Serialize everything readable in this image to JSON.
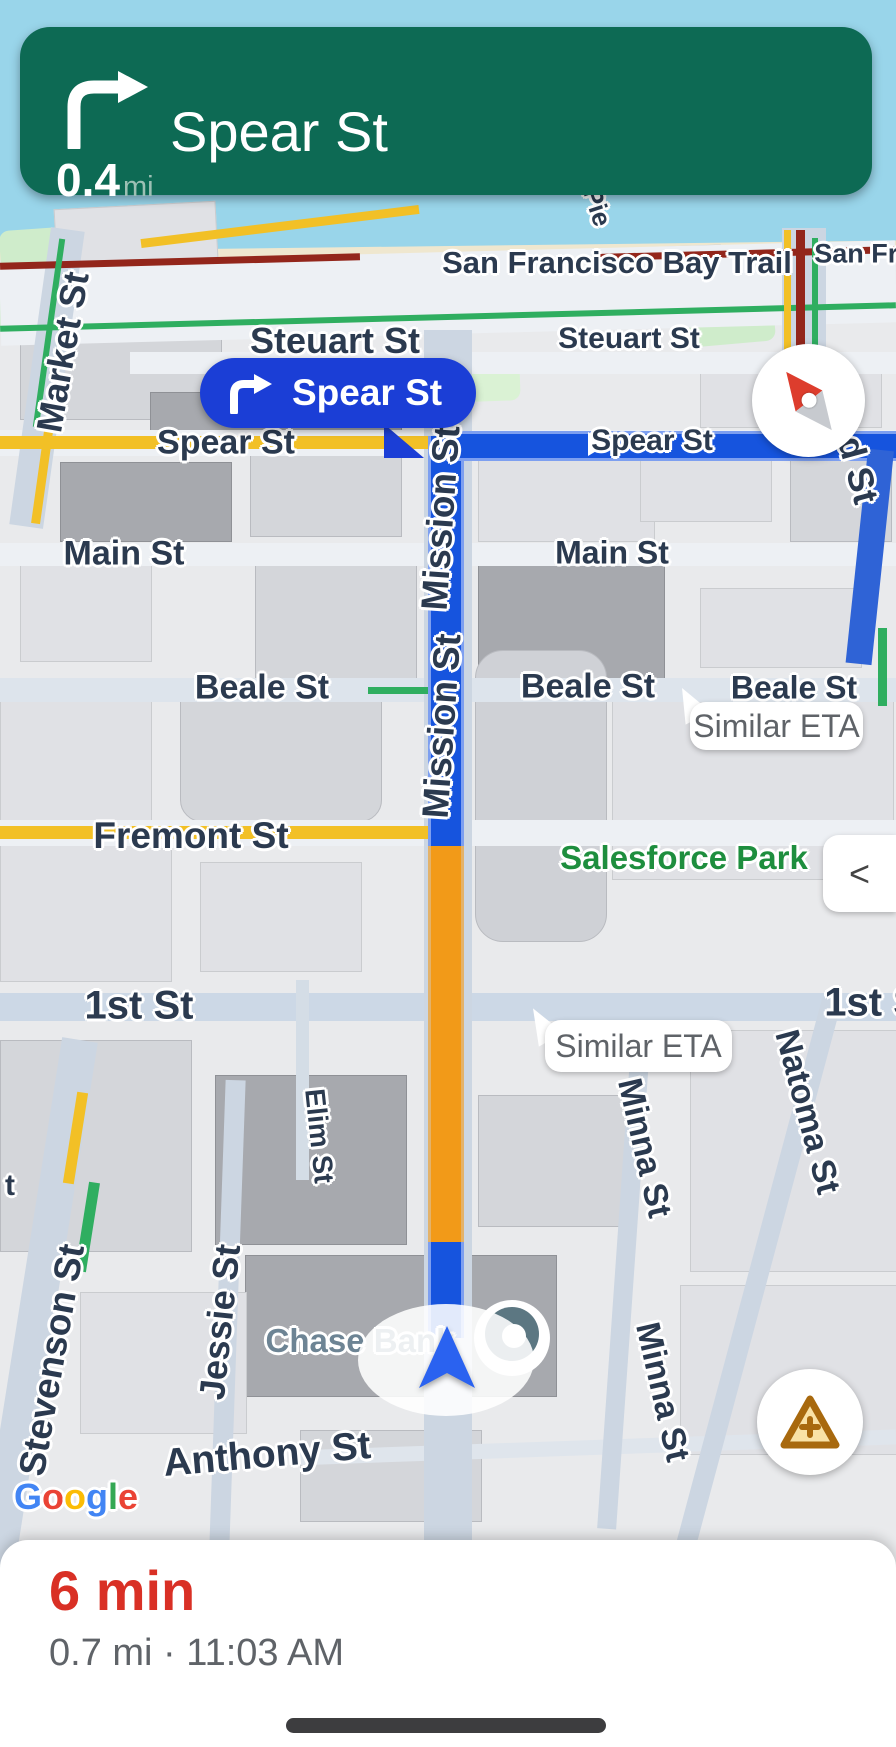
{
  "app": "Google Maps driving navigation",
  "banner": {
    "maneuver": "turn-right",
    "distance_value": "0.4",
    "distance_unit": "mi",
    "instruction": "Spear St"
  },
  "callout": {
    "maneuver": "turn-right",
    "label": "Spear St"
  },
  "bubbles": {
    "beale": "Similar ETA",
    "first": "Similar ETA"
  },
  "controls": {
    "collapse": "<"
  },
  "sheet": {
    "eta": "6 min",
    "details": "0.7 mi · 11:03 AM"
  },
  "streets": {
    "bay_trail": "San Francisco Bay Trail",
    "san_fran_clip": "San Fran",
    "pier": "Pie",
    "market": "Market St",
    "steuart_left": "Steuart St",
    "steuart_right": "Steuart St",
    "spear_left": "Spear St",
    "spear_right": "Spear St",
    "main_left": "Main St",
    "main_right": "Main St",
    "beale_left": "Beale St",
    "beale_mid": "Beale St",
    "beale_right": "Beale St",
    "fremont": "Fremont St",
    "first_left": "1st St",
    "first_right": "1st S",
    "mission_upper": "Mission St",
    "mission_lower": "Mission St",
    "natoma": "Natoma St",
    "minna_upper": "Minna St",
    "minna_lower": "Minna St",
    "elim": "Elim St",
    "jessie": "Jessie St",
    "stevenson": "Stevenson St",
    "anthony": "Anthony St",
    "left_fragment": "t",
    "right_fragment": "d St"
  },
  "pois": {
    "salesforce_park": "Salesforce Park",
    "chase_bank": "Chase Bank"
  },
  "google": {
    "l0": "G",
    "l1": "o",
    "l2": "o",
    "l3": "g",
    "l4": "l",
    "l5": "e"
  },
  "colors": {
    "banner_green": "#0D6A54",
    "callout_blue": "#1B3ED6",
    "route_blue": "#1654DE",
    "congestion_orange": "#F29A18",
    "slow_yellow": "#F2C026",
    "jam_dark_red": "#93261B",
    "transit_green": "#2FAE60",
    "eta_red": "#D93025",
    "park_green_text": "#1E8E3E",
    "water_blue": "#99D5EA"
  }
}
